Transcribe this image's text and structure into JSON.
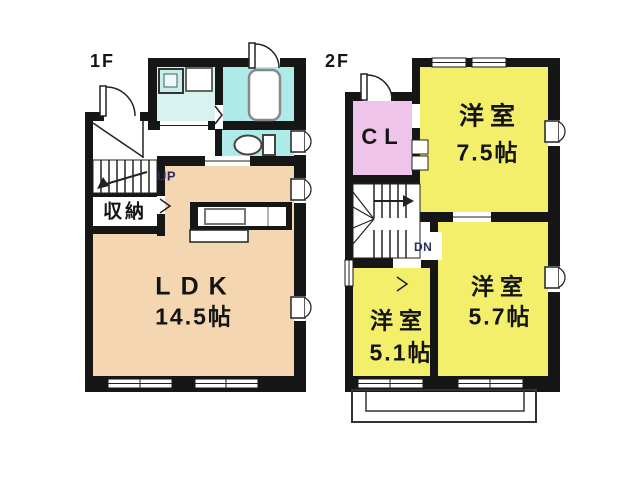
{
  "colors": {
    "wall": "#161616",
    "ldk_floor": "#f4d6b0",
    "room_yellow": "#f3ef6a",
    "closet_pink": "#eec4ea",
    "bath_cyan": "#aeeae8",
    "wash_cyan": "#d8f2f0",
    "stair_label_navy": "#2b2b5e"
  },
  "floor1": {
    "label": "1F",
    "ldk_name": "LDK",
    "ldk_size": "14.5帖",
    "storage_label": "収納",
    "stairs_label": "UP"
  },
  "floor2": {
    "label": "2F",
    "closet_label": "CL",
    "stairs_label": "DN",
    "rooms": [
      {
        "name": "洋室",
        "size": "7.5帖"
      },
      {
        "name": "洋室",
        "size": "5.7帖"
      },
      {
        "name": "洋室",
        "size": "5.1帖"
      }
    ]
  }
}
